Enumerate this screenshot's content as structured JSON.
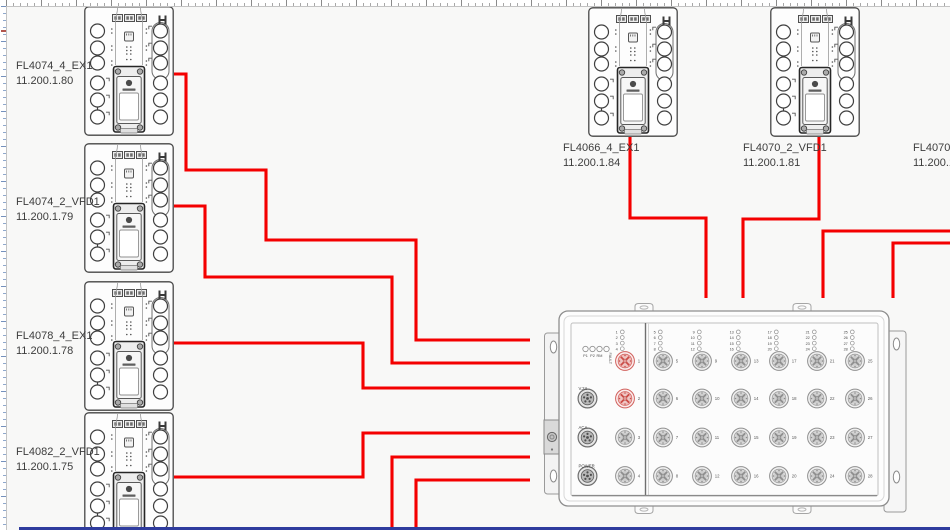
{
  "canvas": {
    "cable_color": "#f40000",
    "highlight_color": "#d1605c",
    "bottom_bar_color": "#2f3c9e"
  },
  "devices": [
    {
      "name": "FL4074_4_EX1",
      "ip": "11.200.1.80"
    },
    {
      "name": "FL4074_2_VFD1",
      "ip": "11.200.1.79"
    },
    {
      "name": "FL4078_4_EX1",
      "ip": "11.200.1.78"
    },
    {
      "name": "FL4082_2_VFD1",
      "ip": "11.200.1.75"
    },
    {
      "name": "FL4066_4_EX1",
      "ip": "11.200.1.84"
    },
    {
      "name": "FL4070_2_VFD1",
      "ip": "11.200.1.81"
    },
    {
      "name": "FL4070_4",
      "ip": "11.200.1."
    }
  ],
  "switch": {
    "status_leds": [
      "P1",
      "P2",
      "RM",
      "FAULT"
    ],
    "side_ports": [
      "V.24",
      "ACA",
      "POWER"
    ],
    "data_ports": [
      1,
      2,
      3,
      4,
      5,
      6,
      7,
      8,
      9,
      10,
      11,
      12,
      13,
      14,
      15,
      16,
      17,
      18,
      19,
      20,
      21,
      22,
      23,
      24,
      25,
      26,
      27,
      28
    ],
    "highlighted_ports": [
      1,
      2
    ]
  },
  "cables": [
    {
      "from": "FL4074_4_EX1",
      "points": [
        [
          174,
          74
        ],
        [
          186,
          74
        ],
        [
          186,
          170
        ],
        [
          266,
          170
        ],
        [
          266,
          240
        ],
        [
          416,
          240
        ],
        [
          416,
          340
        ],
        [
          530,
          340
        ]
      ]
    },
    {
      "from": "FL4074_2_VFD1",
      "points": [
        [
          174,
          206
        ],
        [
          205,
          206
        ],
        [
          205,
          277
        ],
        [
          392,
          277
        ],
        [
          392,
          363
        ],
        [
          530,
          363
        ]
      ]
    },
    {
      "from": "FL4078_4_EX1",
      "points": [
        [
          174,
          343
        ],
        [
          363,
          343
        ],
        [
          363,
          388
        ],
        [
          530,
          388
        ]
      ]
    },
    {
      "from": "FL4082_2_VFD1",
      "points": [
        [
          174,
          477
        ],
        [
          363,
          477
        ],
        [
          363,
          433
        ],
        [
          530,
          433
        ]
      ]
    },
    {
      "from": "offscreen-bottom-1",
      "points": [
        [
          392,
          531
        ],
        [
          392,
          457
        ],
        [
          530,
          457
        ]
      ]
    },
    {
      "from": "offscreen-bottom-2",
      "points": [
        [
          416,
          531
        ],
        [
          416,
          480
        ],
        [
          530,
          480
        ]
      ]
    },
    {
      "from": "FL4066_4_EX1",
      "points": [
        [
          630,
          137
        ],
        [
          630,
          218
        ],
        [
          706,
          218
        ],
        [
          706,
          298
        ]
      ]
    },
    {
      "from": "FL4070_2_VFD1",
      "points": [
        [
          819,
          137
        ],
        [
          819,
          219
        ],
        [
          743,
          219
        ],
        [
          743,
          298
        ]
      ]
    },
    {
      "from": "offscreen-right-1",
      "points": [
        [
          951,
          231
        ],
        [
          823,
          231
        ],
        [
          823,
          298
        ]
      ]
    },
    {
      "from": "offscreen-right-2",
      "points": [
        [
          951,
          243
        ],
        [
          893,
          243
        ],
        [
          893,
          298
        ]
      ]
    }
  ]
}
